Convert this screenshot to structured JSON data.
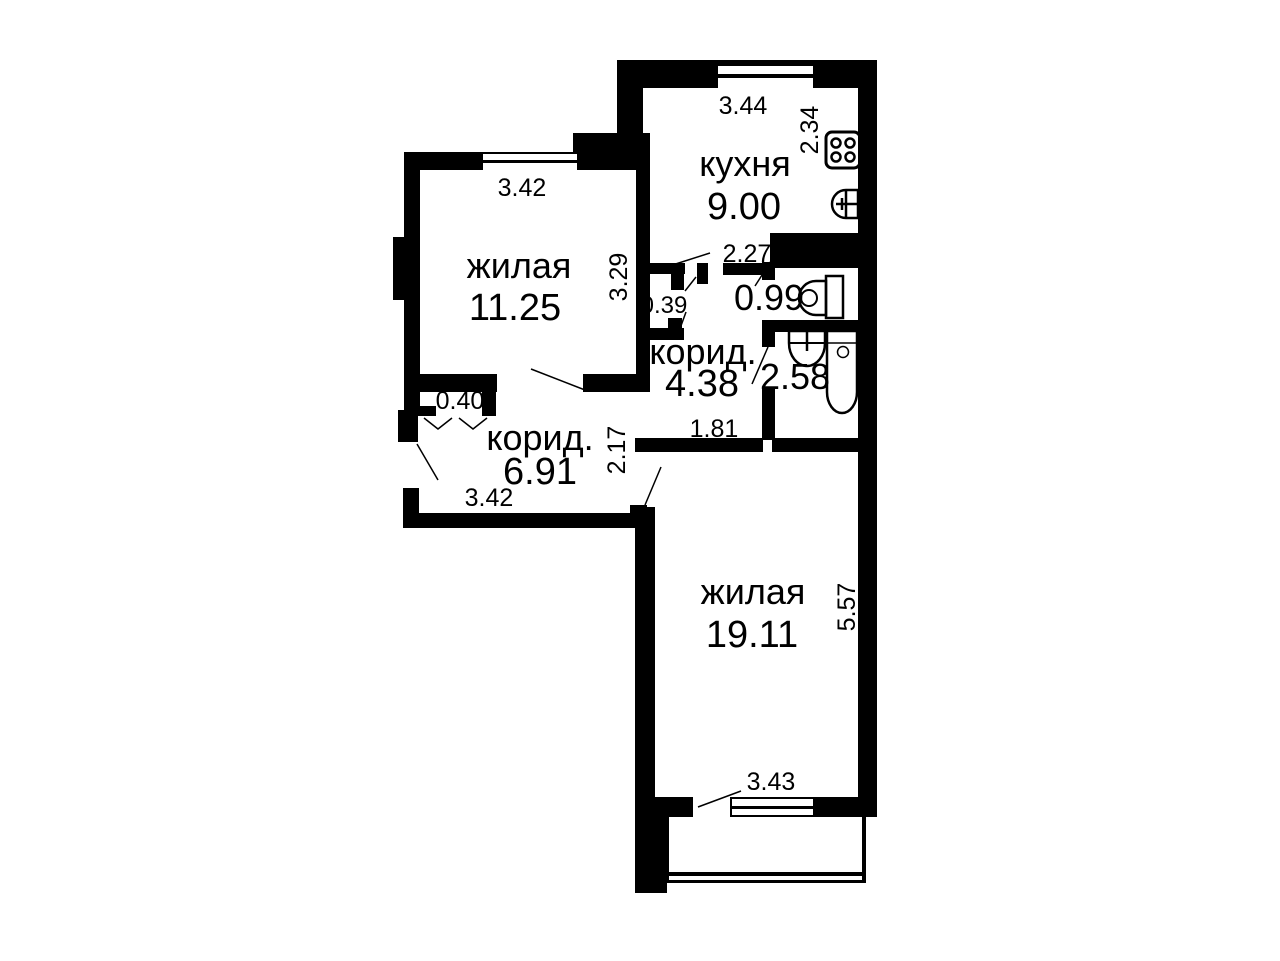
{
  "plan": {
    "rooms": {
      "kitchen": {
        "label": "кухня",
        "area": "9.00"
      },
      "living1": {
        "label": "жилая",
        "area": "11.25"
      },
      "corridor1": {
        "label": "корид.",
        "area": "4.38"
      },
      "corridor2": {
        "label": "корид.",
        "area": "6.91"
      },
      "living2": {
        "label": "жилая",
        "area": "19.11"
      },
      "wc": {
        "area": "0.99"
      },
      "bathroom": {
        "area": "2.58"
      }
    },
    "dimensions": {
      "kitchen_width": "3.44",
      "kitchen_depth": "2.34",
      "living1_width": "3.42",
      "living1_depth": "3.29",
      "kitchen_door": "2.27",
      "niche": "0.39",
      "corridor1_width": "1.81",
      "entry_niche": "0.40",
      "corridor2_depth": "2.17",
      "corridor2_width": "3.42",
      "living2_depth": "5.57",
      "balcony_door": "3.43"
    },
    "watermark": {
      "line1": "Я С",
      "line2": "во не"
    },
    "colors": {
      "wall": "#000000",
      "background": "#ffffff",
      "fixture": "#000000",
      "watermark_big": "#efefef",
      "watermark_small": "#bdbdbd"
    }
  }
}
